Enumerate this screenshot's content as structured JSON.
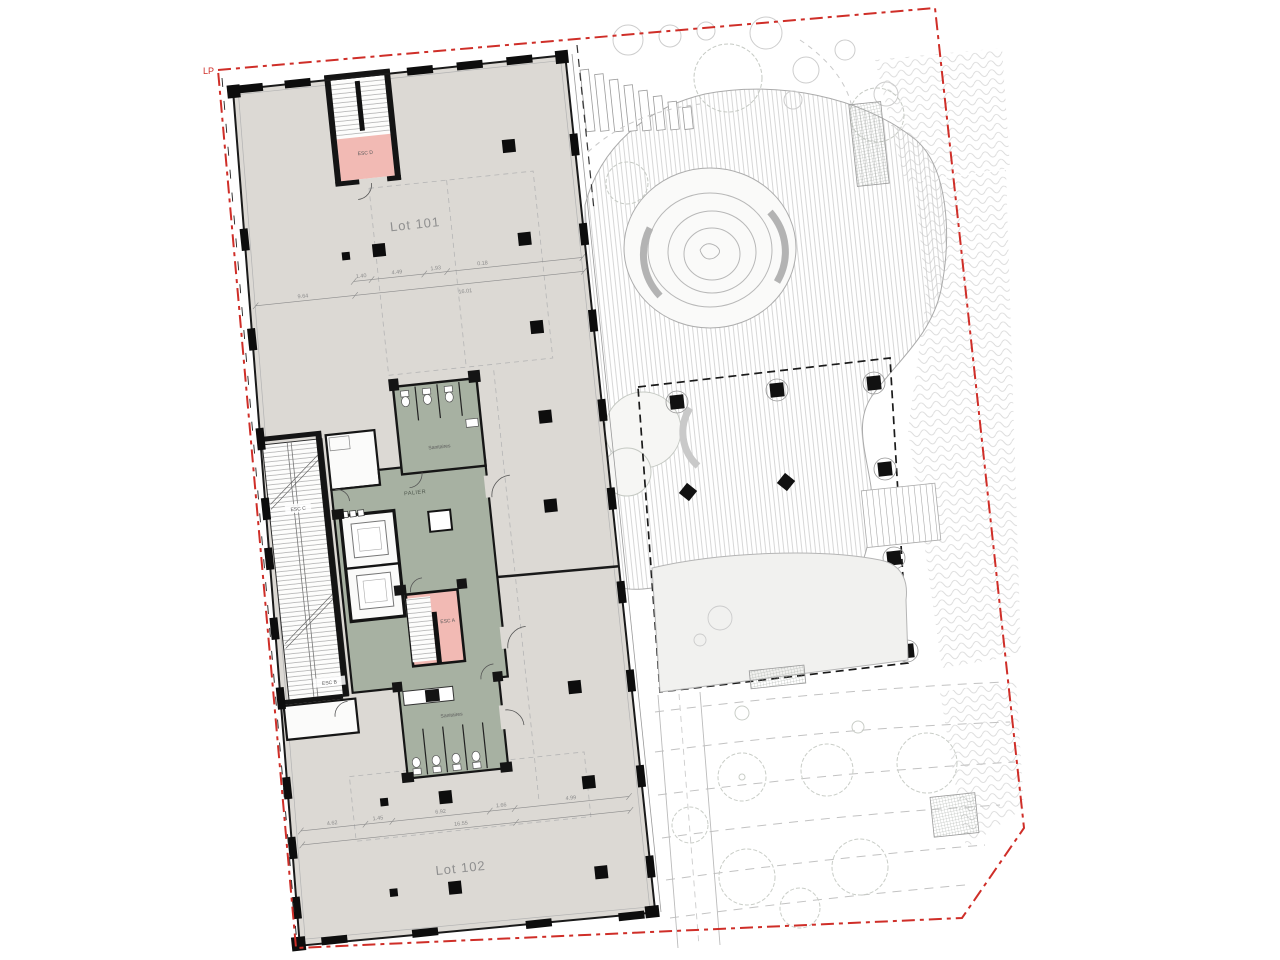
{
  "drawing": {
    "site_label": "LP",
    "lots": {
      "lot101": "Lot 101",
      "lot102": "Lot 102"
    },
    "core": {
      "palier": "PALIER",
      "sanitaires_top": "Sanitaires",
      "sanitaires_bottom": "Sanitaires"
    },
    "stairs": {
      "esc_a": "ESC A",
      "esc_b": "ESC B",
      "esc_c": "ESC C",
      "esc_d": "ESC D"
    },
    "dimensions": {
      "top": {
        "segments": [
          "9.64",
          "1.40",
          "4.49",
          "1.93",
          "0.18"
        ],
        "total": "16.01"
      },
      "bottom": {
        "segments": [
          "4.62",
          "1.45",
          "6.92",
          "1.66",
          "4.99"
        ],
        "total": "16.55"
      }
    },
    "colors": {
      "boundary": "#cf2e28",
      "floor": "#dcd9d4",
      "core_green": "#a7b1a2",
      "stair_pink": "#f2bab4",
      "wall": "#161616"
    }
  }
}
